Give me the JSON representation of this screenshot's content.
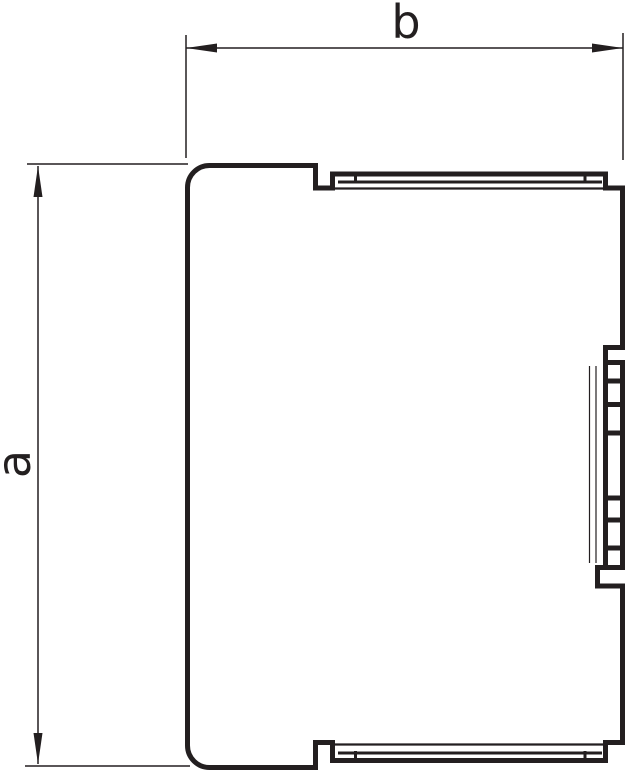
{
  "drawing": {
    "kind": "technical-cross-section-profile",
    "labels": {
      "width_dimension": "b",
      "height_dimension": "a"
    },
    "colors": {
      "line": "#231f20",
      "background": "#ffffff"
    }
  }
}
